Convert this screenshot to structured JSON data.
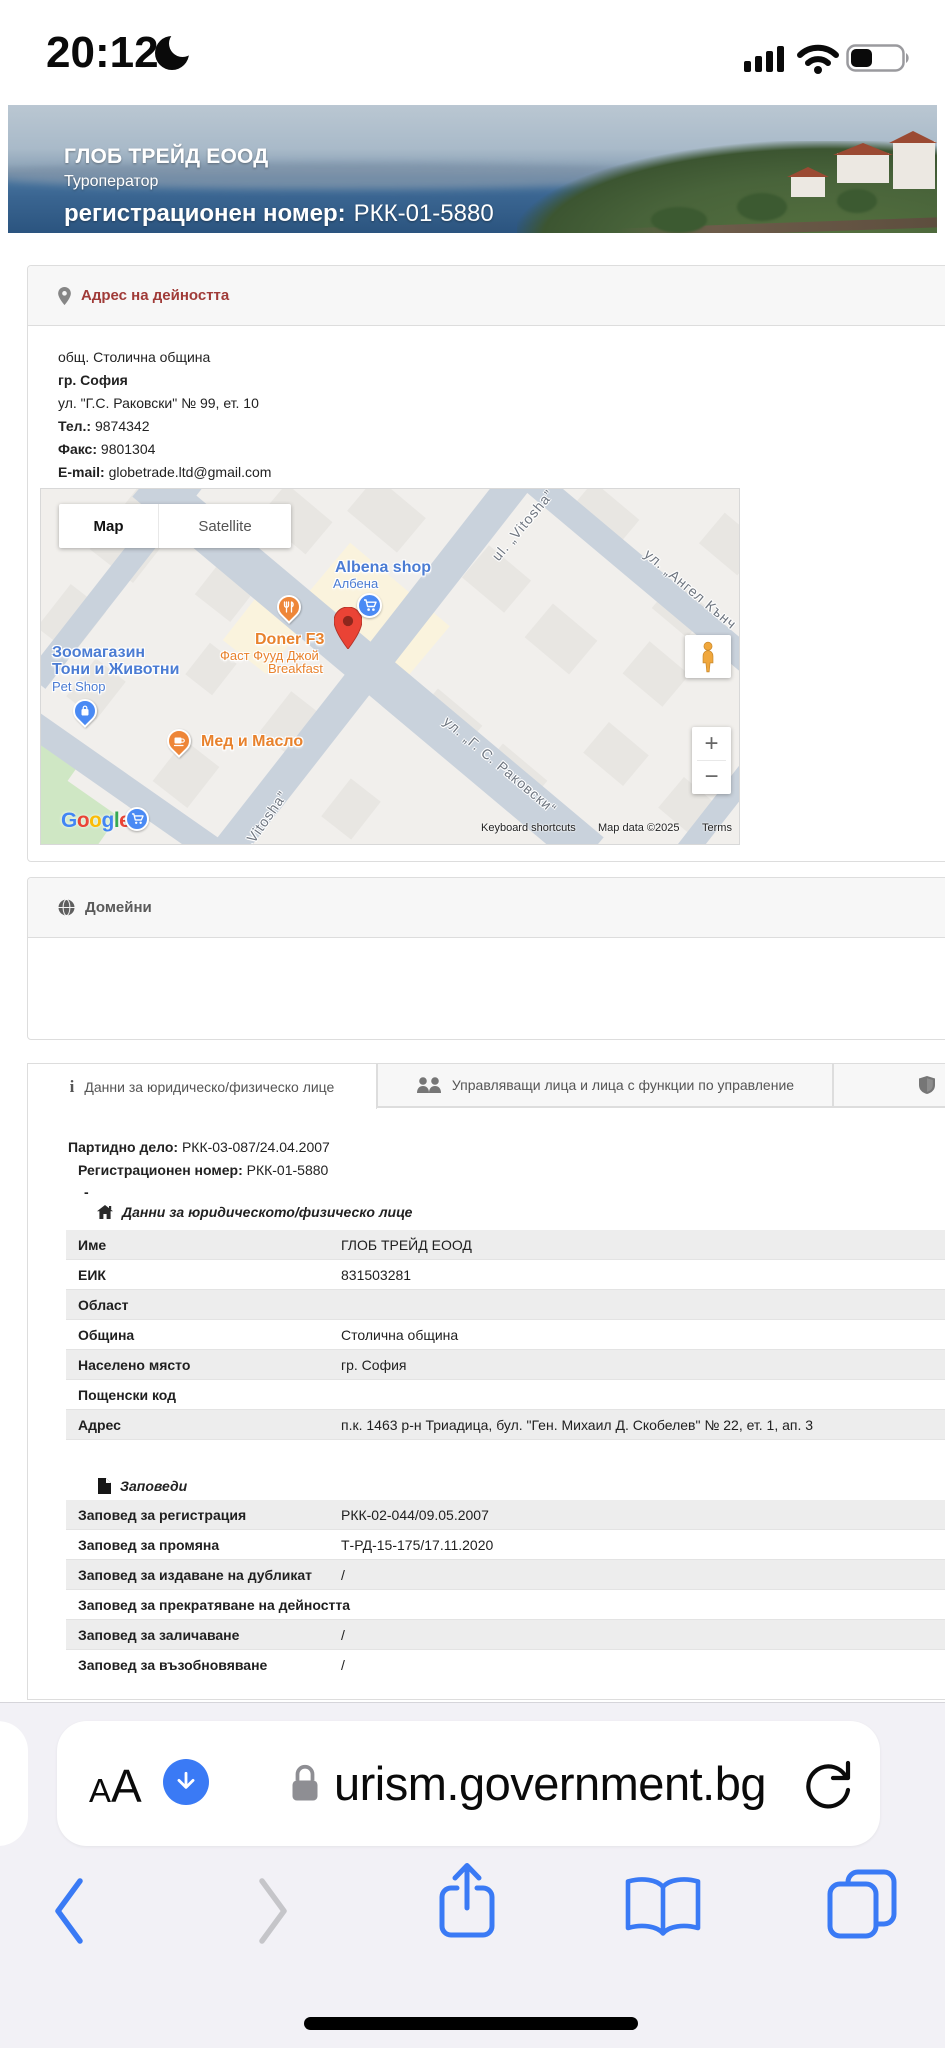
{
  "status_bar": {
    "time": "20:12"
  },
  "banner": {
    "company_name": "ГЛОБ ТРЕЙД ЕООД",
    "company_type": "Туроператор",
    "reg_label": "регистрационен номер:",
    "reg_number": "РКК-01-5880"
  },
  "address_section": {
    "title": "Адрес на дейността",
    "municipality": "общ. Столична община",
    "city": "гр. София",
    "street": "ул. \"Г.С. Раковски\" № 99, ет. 10",
    "phone_label": "Тел.:",
    "phone": "9874342",
    "fax_label": "Факс:",
    "fax": "9801304",
    "email_label": "E-mail:",
    "email": "globetrade.ltd@gmail.com"
  },
  "map": {
    "controls": {
      "map": "Map",
      "satellite": "Satellite",
      "zoom_in": "+",
      "zoom_out": "−"
    },
    "pois": {
      "albena": {
        "name": "Albena shop",
        "sub": "Албена"
      },
      "doner": {
        "name": "Doner F3",
        "sub1": "Фаст Фууд Джой",
        "sub2": "Breakfast"
      },
      "zoo": {
        "line1": "Зоомагазин",
        "line2": "Тони и Животни",
        "sub": "Pet Shop"
      },
      "med": {
        "name": "Мед и Масло"
      }
    },
    "streets": {
      "vitosha_top": "ul. „Vitosha”",
      "angel": "ул. „Ангел Кънч",
      "rakovski": "ул. „Г. С. Раковски“",
      "vitosha_bottom": "„Vitosha”"
    },
    "google_letters": [
      "G",
      "o",
      "o",
      "g",
      "l",
      "e"
    ],
    "attribution": {
      "shortcuts": "Keyboard shortcuts",
      "data": "Map data ©2025",
      "terms": "Terms"
    }
  },
  "domains_section": {
    "title": "Домейни"
  },
  "tabs": [
    {
      "label": "Данни за юридическо/физическо лице"
    },
    {
      "label": "Управляващи лица и лица с функции по управление"
    },
    {
      "label": "Застрах"
    }
  ],
  "details": {
    "file_label": "Партидно дело:",
    "file_value": "РКК-03-087/24.04.2007",
    "reg_label": "Регистрационен номер:",
    "reg_value": "РКК-01-5880",
    "dash": "-",
    "entity_header": "Данни за юридическото/физическо лице",
    "rows": [
      {
        "label": "Име",
        "value": "ГЛОБ ТРЕЙД ЕООД"
      },
      {
        "label": "ЕИК",
        "value": "831503281"
      },
      {
        "label": "Област",
        "value": ""
      },
      {
        "label": "Община",
        "value": "Столична община"
      },
      {
        "label": "Населено място",
        "value": "гр. София"
      },
      {
        "label": "Пощенски код",
        "value": ""
      },
      {
        "label": "Адрес",
        "value": "п.к. 1463 р-н Триадица, бул. \"Ген. Михаил Д. Скобелев\" № 22, ет. 1, ап. 3"
      }
    ],
    "orders_header": "Заповеди",
    "order_rows": [
      {
        "label": "Заповед за регистрация",
        "value": "РКК-02-044/09.05.2007"
      },
      {
        "label": "Заповед за промяна",
        "value": "Т-РД-15-175/17.11.2020"
      },
      {
        "label": "Заповед за издаване на дубликат",
        "value": "/"
      },
      {
        "label": "Заповед за прекратяване на дейността",
        "value": ""
      },
      {
        "label": "Заповед за заличаване",
        "value": "/"
      },
      {
        "label": "Заповед за възобновяване",
        "value": "/"
      }
    ]
  },
  "safari": {
    "reader_button": "AA",
    "url": "urism.government.bg"
  }
}
